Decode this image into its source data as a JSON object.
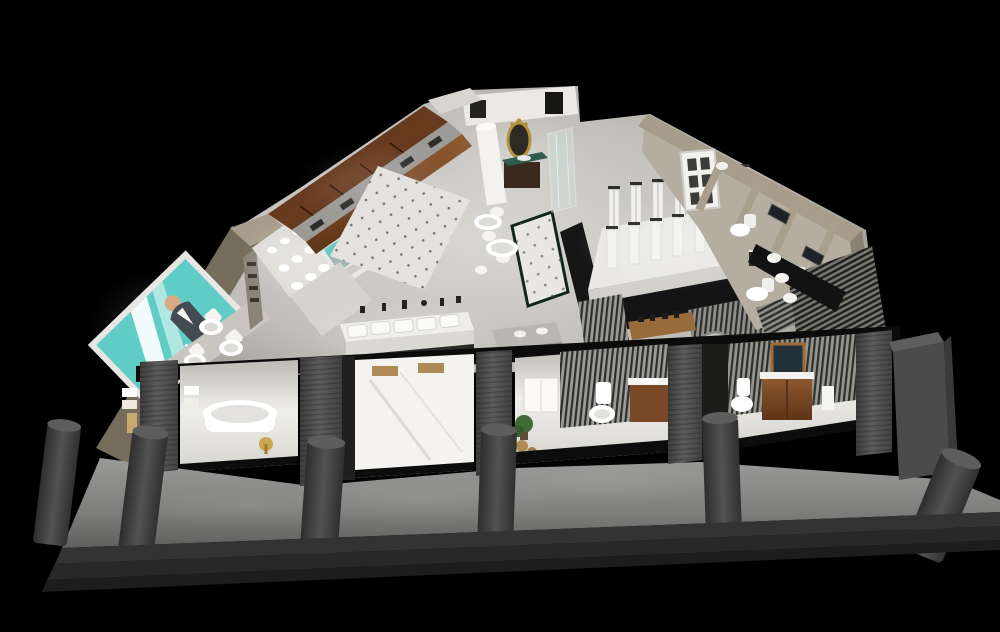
{
  "meta": {
    "type": "3d-showroom-render",
    "subject": "bathroom sanitary-ware showroom cutaway seen from above at night",
    "background": "#000000",
    "view": "isometric bird's-eye cutaway"
  },
  "brand_sign": {
    "text": "AGGILA",
    "panel_color": "#5fccc6",
    "frame_color": "#eceae6",
    "text_color": "#ffffff"
  },
  "palette": {
    "background": "#000000",
    "teal": "#5fccc6",
    "gold": "#b5913f",
    "floor_bright": "#f2f1ee",
    "floor_mid": "#d8d6d1",
    "floor_dim": "#a5a29c",
    "wood_dark": "#4a2a16",
    "wood_mid": "#7a4a28",
    "wood_light": "#a06a38",
    "beige_wall": "#a89d8a",
    "beige_wall_dark": "#756c5c",
    "pillar_gray": "#4f4f4f",
    "bollard_gray": "#3e3e3e",
    "sidewalk_gray": "#8a8a88",
    "step_dark": "#262626",
    "beam_black": "#0b0b0b",
    "walkway_dark": "#161616",
    "tile_dot": "#54544f",
    "glass_tint": "#cfe0de",
    "plant_green": "#3f6b38",
    "marble_green": "#2e5c4e",
    "slat_light": "#9a9a96",
    "slat_dark": "#2e2e2c"
  },
  "scene": {
    "areas": [
      "brand-billboard-wall",
      "toilet-display-ledge",
      "basin-shelf-wall",
      "wood-cabinet-run",
      "dotted-tile-walkway",
      "faucet-display-tables",
      "luxury-vanity-room",
      "glass-shower-cabin",
      "shower-column-platform",
      "slatted-partitions",
      "right-wing-bathroom-rooms",
      "storefront-display-bays",
      "sidewalk-with-bollards",
      "entry-steps"
    ],
    "counts": {
      "front_bollards": 6,
      "entry_steps": 3,
      "storefront_bays": 4,
      "storefront_pillars": 5,
      "shower_columns_back_row": 7,
      "shower_columns_front_row": 6,
      "display_toilets_left_ledge": 3,
      "faucet_trays": 5,
      "right_wing_partitions": 4
    }
  }
}
